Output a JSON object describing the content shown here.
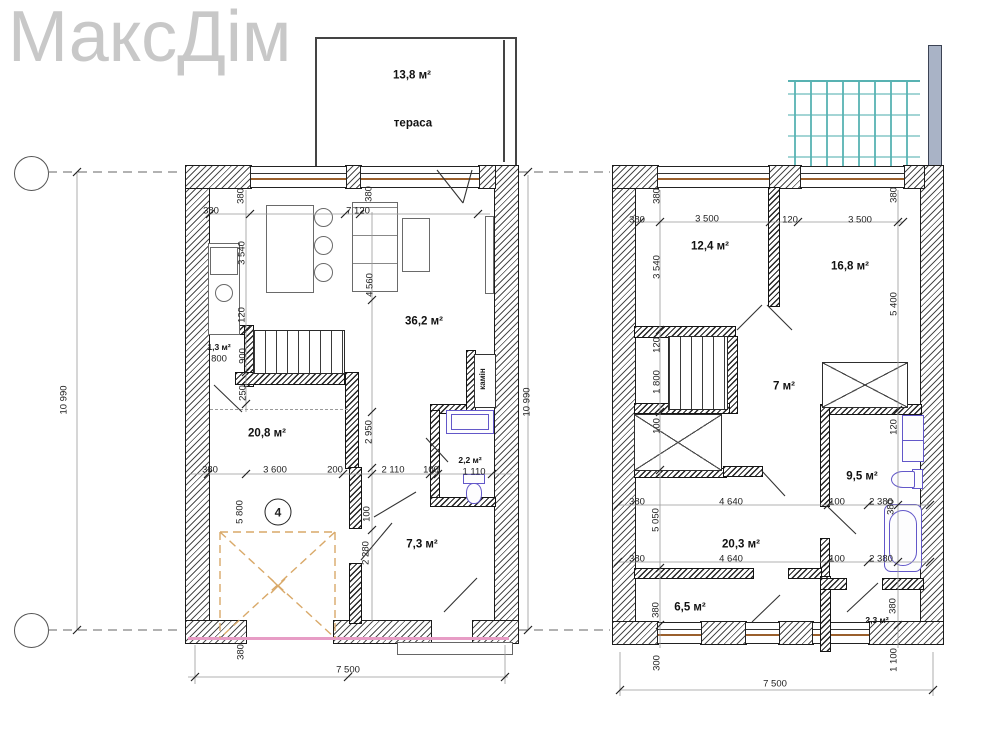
{
  "logo": "МаксДім",
  "colors": {
    "logo_gray": "#c8c8c8",
    "wall_hatch": "#2d2d2d",
    "fixture_purple": "#6257c9",
    "garage_dash_orange": "#d9a969",
    "balustrade_teal": "#58b2b2",
    "bottom_pink_line": "#e79cc5",
    "window_sill_brown": "#9a5f2c"
  },
  "ground_floor": {
    "labels": [
      {
        "t": "13,8 м²",
        "x": 412,
        "y": 76,
        "cls": "room"
      },
      {
        "t": "тераса",
        "x": 413,
        "y": 124,
        "cls": "room"
      },
      {
        "t": "36,2 м²",
        "x": 424,
        "y": 322,
        "cls": "room"
      },
      {
        "t": "1,3 м²",
        "x": 219,
        "y": 347,
        "cls": "room sm"
      },
      {
        "t": "800",
        "x": 219,
        "y": 359
      },
      {
        "t": "20,8 м²",
        "x": 267,
        "y": 434,
        "cls": "room"
      },
      {
        "t": "2,2 м²",
        "x": 470,
        "y": 460,
        "cls": "room sm"
      },
      {
        "t": "1 110",
        "x": 474,
        "y": 472
      },
      {
        "t": "7,3 м²",
        "x": 422,
        "y": 545,
        "cls": "room"
      },
      {
        "t": "камін",
        "x": 483,
        "y": 379,
        "v": true,
        "cls": "fire"
      },
      {
        "t": "4",
        "x": 278,
        "y": 512,
        "cls": "spot"
      },
      {
        "t": "380",
        "x": 211,
        "y": 211
      },
      {
        "t": "380",
        "x": 241,
        "y": 196,
        "v": true
      },
      {
        "t": "7 120",
        "x": 358,
        "y": 211
      },
      {
        "t": "380",
        "x": 369,
        "y": 194,
        "v": true
      },
      {
        "t": "3 540",
        "x": 242,
        "y": 253,
        "v": true
      },
      {
        "t": "120",
        "x": 242,
        "y": 315,
        "v": true
      },
      {
        "t": "4 560",
        "x": 370,
        "y": 285,
        "v": true
      },
      {
        "t": "900",
        "x": 243,
        "y": 356,
        "v": true
      },
      {
        "t": "250",
        "x": 243,
        "y": 393,
        "v": true
      },
      {
        "t": "2 950",
        "x": 369,
        "y": 432,
        "v": true
      },
      {
        "t": "380",
        "x": 210,
        "y": 470
      },
      {
        "t": "3 600",
        "x": 275,
        "y": 470
      },
      {
        "t": "200",
        "x": 335,
        "y": 470
      },
      {
        "t": "2 110",
        "x": 393,
        "y": 470
      },
      {
        "t": "100",
        "x": 431,
        "y": 470
      },
      {
        "t": "100",
        "x": 367,
        "y": 514,
        "v": true
      },
      {
        "t": "2 280",
        "x": 366,
        "y": 553,
        "v": true
      },
      {
        "t": "5 800",
        "x": 240,
        "y": 512,
        "v": true
      },
      {
        "t": "380",
        "x": 241,
        "y": 652,
        "v": true
      },
      {
        "t": "7 500",
        "x": 348,
        "y": 670
      },
      {
        "t": "10 990",
        "x": 64,
        "y": 400,
        "v": true
      },
      {
        "t": "10 990",
        "x": 527,
        "y": 402,
        "v": true
      }
    ]
  },
  "second_floor": {
    "labels": [
      {
        "t": "12,4 м²",
        "x": 710,
        "y": 247,
        "cls": "room"
      },
      {
        "t": "16,8 м²",
        "x": 850,
        "y": 267,
        "cls": "room"
      },
      {
        "t": "7 м²",
        "x": 784,
        "y": 387,
        "cls": "room"
      },
      {
        "t": "9,5 м²",
        "x": 862,
        "y": 477,
        "cls": "room"
      },
      {
        "t": "20,3 м²",
        "x": 741,
        "y": 545,
        "cls": "room"
      },
      {
        "t": "6,5 м²",
        "x": 690,
        "y": 608,
        "cls": "room"
      },
      {
        "t": "2,3 м²",
        "x": 877,
        "y": 620,
        "cls": "room sm"
      },
      {
        "t": "380",
        "x": 637,
        "y": 220
      },
      {
        "t": "3 500",
        "x": 707,
        "y": 219
      },
      {
        "t": "120",
        "x": 790,
        "y": 220
      },
      {
        "t": "3 500",
        "x": 860,
        "y": 220
      },
      {
        "t": "380",
        "x": 657,
        "y": 196,
        "v": true
      },
      {
        "t": "380",
        "x": 894,
        "y": 195,
        "v": true
      },
      {
        "t": "3 540",
        "x": 657,
        "y": 267,
        "v": true
      },
      {
        "t": "5 400",
        "x": 894,
        "y": 304,
        "v": true
      },
      {
        "t": "120",
        "x": 657,
        "y": 345,
        "v": true
      },
      {
        "t": "1 800",
        "x": 657,
        "y": 382,
        "v": true
      },
      {
        "t": "100",
        "x": 657,
        "y": 426,
        "v": true
      },
      {
        "t": "120",
        "x": 894,
        "y": 427,
        "v": true
      },
      {
        "t": "380",
        "x": 637,
        "y": 502
      },
      {
        "t": "4 640",
        "x": 731,
        "y": 502
      },
      {
        "t": "100",
        "x": 837,
        "y": 502
      },
      {
        "t": "2 380",
        "x": 881,
        "y": 502
      },
      {
        "t": "380",
        "x": 891,
        "y": 507,
        "v": true
      },
      {
        "t": "5 050",
        "x": 656,
        "y": 520,
        "v": true
      },
      {
        "t": "380",
        "x": 637,
        "y": 559
      },
      {
        "t": "4 640",
        "x": 731,
        "y": 559
      },
      {
        "t": "100",
        "x": 837,
        "y": 559
      },
      {
        "t": "2 380",
        "x": 881,
        "y": 559
      },
      {
        "t": "380",
        "x": 656,
        "y": 610,
        "v": true
      },
      {
        "t": "380",
        "x": 893,
        "y": 606,
        "v": true
      },
      {
        "t": "300",
        "x": 657,
        "y": 663,
        "v": true
      },
      {
        "t": "1 100",
        "x": 894,
        "y": 660,
        "v": true
      },
      {
        "t": "7 500",
        "x": 775,
        "y": 684
      }
    ]
  }
}
